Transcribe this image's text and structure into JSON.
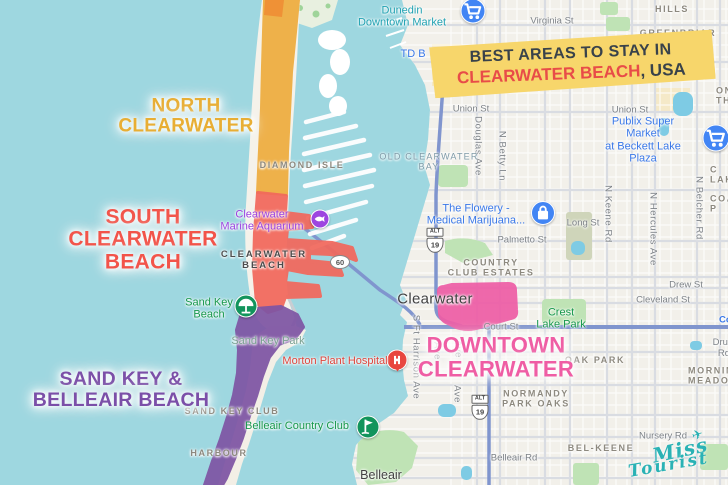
{
  "banner": {
    "line1": "BEST AREAS TO STAY IN",
    "line2_highlight": "CLEARWATER BEACH",
    "line2_suffix": ", USA",
    "bg_color": "#f7d66b",
    "highlight_color": "#e84c48",
    "text_color": "#39424a"
  },
  "logo": {
    "text1": "Miss",
    "text2": "Tourist",
    "plane": "✈",
    "color": "#2ab2b5"
  },
  "theme": {
    "water": "#9ed7e0",
    "land": "#f2f0ea",
    "park": "#bfe3b5",
    "pond": "#7ecbe4",
    "highway": "#8095ce"
  },
  "regions": [
    {
      "id": "north-clearwater",
      "label": "NORTH\nCLEARWATER",
      "color": "#eead3e",
      "cap_color": "#ee8f35",
      "label_color": "#e8ae34",
      "overlay_id": "ov-north",
      "cap_id": "ov-north-cap",
      "label_x": 186,
      "label_y": 117,
      "font_px": 19
    },
    {
      "id": "south-clearwater-beach",
      "label": "SOUTH\nCLEARWATER\nBEACH",
      "color": "#f2685c",
      "label_color": "#f2544a",
      "overlay_id": "ov-south",
      "label_x": 143,
      "label_y": 240,
      "font_px": 21
    },
    {
      "id": "sand-key-belleair-beach",
      "label": "SAND KEY &\nBELLEAIR BEACH",
      "color": "#7e55a4",
      "label_color": "#7b4fa8",
      "overlay_id": "ov-sandkey",
      "label_x": 121,
      "label_y": 390,
      "font_px": 19.5
    },
    {
      "id": "downtown-clearwater",
      "label": "DOWNTOWN\nCLEARWATER",
      "color": "#ee5ea6",
      "label_color": "#ef5da4",
      "overlay_id": "ov-downtown",
      "label_x": 496,
      "label_y": 357,
      "font_px": 22
    }
  ],
  "map": {
    "labels": [
      {
        "n": "street-virginia-st",
        "t": "Virginia St",
        "c": "st",
        "x": 552,
        "y": 22,
        "k": false
      },
      {
        "n": "street-union-st-west",
        "t": "Union St",
        "c": "st",
        "x": 471,
        "y": 110,
        "k": false
      },
      {
        "n": "street-union-st-east",
        "t": "Union St",
        "c": "st",
        "x": 630,
        "y": 111,
        "k": false
      },
      {
        "n": "street-long-st",
        "t": "Long St",
        "c": "st",
        "x": 583,
        "y": 224,
        "k": false
      },
      {
        "n": "street-palmetto-st",
        "t": "Palmetto St",
        "c": "st",
        "x": 522,
        "y": 241,
        "k": false
      },
      {
        "n": "street-court-st",
        "t": "Court St",
        "c": "st",
        "x": 501,
        "y": 328,
        "k": false
      },
      {
        "n": "street-drew-st",
        "t": "Drew St",
        "c": "st",
        "x": 686,
        "y": 286,
        "k": false
      },
      {
        "n": "street-cleveland-st",
        "t": "Cleveland St",
        "c": "st",
        "x": 663,
        "y": 301,
        "k": false
      },
      {
        "n": "street-druid-rd",
        "t": "Druid Rd",
        "c": "st",
        "x": 724,
        "y": 349,
        "k": false
      },
      {
        "n": "street-belleair-rd",
        "t": "Belleair Rd",
        "c": "st",
        "x": 514,
        "y": 459,
        "k": false
      },
      {
        "n": "street-nursery-rd",
        "t": "Nursery Rd",
        "c": "st",
        "x": 663,
        "y": 437,
        "k": false
      },
      {
        "n": "street-court-hwy-label",
        "t": "Cou",
        "c": "stb",
        "x": 719,
        "y": 321,
        "k": false,
        "la": true
      },
      {
        "n": "street-douglas-ave",
        "t": "Douglas Ave",
        "c": "stv",
        "x": 477,
        "y": 146,
        "k": false
      },
      {
        "n": "street-n-betty-ln",
        "t": "N Betty Ln",
        "c": "stv",
        "x": 501,
        "y": 156,
        "k": false
      },
      {
        "n": "street-n-keene-rd",
        "t": "N Keene Rd",
        "c": "stv",
        "x": 607,
        "y": 214,
        "k": false
      },
      {
        "n": "street-n-hercules-ave",
        "t": "N Hercules Ave",
        "c": "stv",
        "x": 652,
        "y": 229,
        "k": false
      },
      {
        "n": "street-n-belcher-rd",
        "t": "N Belcher Rd",
        "c": "stv",
        "x": 698,
        "y": 208,
        "k": false
      },
      {
        "n": "street-s-ft-harrison-ave",
        "t": "S Ft Harrison Ave",
        "c": "stv",
        "x": 415,
        "y": 357,
        "k": false
      },
      {
        "n": "street-ave-fragment-1",
        "t": "Ave",
        "c": "stv",
        "x": 436,
        "y": 351,
        "k": false
      },
      {
        "n": "street-ave-fragment-2",
        "t": "Ave",
        "c": "stv",
        "x": 457,
        "y": 349,
        "k": false
      },
      {
        "n": "street-ave-fragment-3",
        "t": "Ave",
        "c": "stv",
        "x": 456,
        "y": 394,
        "k": false
      },
      {
        "n": "hood-hills",
        "t": "HILLS",
        "c": "hd",
        "x": 672,
        "y": 9,
        "k": false
      },
      {
        "n": "hood-greenbriar",
        "t": "GREENBRIAR",
        "c": "hd",
        "x": 678,
        "y": 33,
        "k": false
      },
      {
        "n": "hood-diamond-isle",
        "t": "DIAMOND ISLE",
        "c": "hd",
        "x": 302,
        "y": 165,
        "k": false
      },
      {
        "n": "hood-country-club-estates",
        "t": "COUNTRY\nCLUB ESTATES",
        "c": "hd",
        "x": 491,
        "y": 268,
        "k": false
      },
      {
        "n": "hood-oak-park",
        "t": "OAK PARK",
        "c": "hd",
        "x": 595,
        "y": 360,
        "k": false
      },
      {
        "n": "hood-morningside-meadows",
        "t": "MORNINGSIDE\nMEADOWS",
        "c": "hd",
        "x": 688,
        "y": 376,
        "k": false,
        "la": true
      },
      {
        "n": "hood-normandy-park-oaks",
        "t": "NORMANDY\nPARK OAKS",
        "c": "hd",
        "x": 536,
        "y": 399,
        "k": false
      },
      {
        "n": "hood-bel-keene",
        "t": "BEL-KEENE",
        "c": "hd",
        "x": 601,
        "y": 448,
        "k": false
      },
      {
        "n": "hood-sand-key-club",
        "t": "SAND KEY CLUB",
        "c": "hd",
        "x": 232,
        "y": 411,
        "k": false
      },
      {
        "n": "hood-harbour",
        "t": "HARBOUR",
        "c": "hd",
        "x": 219,
        "y": 453,
        "k": false
      },
      {
        "n": "hood-edge-fragment-on",
        "t": "ON\nTH",
        "c": "hd",
        "x": 716,
        "y": 96,
        "k": false,
        "la": true
      },
      {
        "n": "hood-edge-fragment-lak",
        "t": "C\nLAK",
        "c": "hd",
        "x": 710,
        "y": 175,
        "k": false,
        "la": true
      },
      {
        "n": "hood-edge-fragment-coa",
        "t": "COA\nP",
        "c": "hd",
        "x": 710,
        "y": 204,
        "k": false,
        "la": true
      },
      {
        "n": "hood-clearwater-beach",
        "t": "CLEARWATER\nBEACH",
        "c": "hdd",
        "x": 264,
        "y": 261,
        "k": false
      },
      {
        "n": "water-old-clearwater-bay",
        "t": "OLD CLEARWATER\nBAY",
        "c": "wt",
        "x": 429,
        "y": 162,
        "k": false
      },
      {
        "n": "city-clearwater",
        "t": "Clearwater",
        "c": "city",
        "x": 435,
        "y": 299,
        "k": false
      },
      {
        "n": "city-belleair",
        "t": "Belleair",
        "c": "city2",
        "x": 381,
        "y": 475,
        "k": false
      },
      {
        "n": "poi-dunedin-downtown-market",
        "t": "Dunedin\nDowntown Market",
        "c": "poit",
        "x": 402,
        "y": 17,
        "k": true
      },
      {
        "n": "poi-td-bank",
        "t": "TD B",
        "c": "poi",
        "x": 413,
        "y": 54,
        "k": true
      },
      {
        "n": "poi-publix-super-market",
        "t": "Publix Super Market\nat Beckett Lake Plaza",
        "c": "poi",
        "x": 643,
        "y": 140,
        "k": true
      },
      {
        "n": "poi-the-flowery",
        "t": "The Flowery -\nMedical Marijuana...",
        "c": "poi",
        "x": 476,
        "y": 215,
        "k": true
      },
      {
        "n": "poi-clearwater-marine-aquarium",
        "t": "Clearwater\nMarine Aquarium",
        "c": "poip",
        "x": 262,
        "y": 221,
        "k": true
      },
      {
        "n": "poi-morton-plant-hospital",
        "t": "Morton Plant Hospital",
        "c": "poir",
        "x": 335,
        "y": 361,
        "k": true
      },
      {
        "n": "poi-sand-key-beach",
        "t": "Sand Key\nBeach",
        "c": "poig",
        "x": 209,
        "y": 309,
        "k": true
      },
      {
        "n": "poi-sand-key-park",
        "t": "Sand Key Park",
        "c": "poik",
        "x": 268,
        "y": 341,
        "k": false
      },
      {
        "n": "poi-belleair-country-club",
        "t": "Belleair Country Club",
        "c": "poig",
        "x": 297,
        "y": 426,
        "k": true
      },
      {
        "n": "poi-crest-lake-park",
        "t": "Crest\nLake Park",
        "c": "poig",
        "x": 561,
        "y": 319,
        "k": true
      }
    ],
    "icons": [
      {
        "name": "shopping-cart-icon",
        "glyph": "cart",
        "x": 473,
        "y": 11,
        "d": 23,
        "c": "#4285f4"
      },
      {
        "name": "shopping-cart-icon",
        "glyph": "cart",
        "x": 716,
        "y": 138,
        "d": 25,
        "c": "#4285f4"
      },
      {
        "name": "shopping-bag-icon",
        "glyph": "bag",
        "x": 543,
        "y": 213,
        "d": 22,
        "c": "#4285f4"
      },
      {
        "name": "aquarium-fish-icon",
        "glyph": "fish",
        "x": 320,
        "y": 219,
        "d": 17,
        "c": "#9d45e0"
      },
      {
        "name": "hospital-icon",
        "glyph": "hospital",
        "x": 397,
        "y": 360,
        "d": 19,
        "c": "#e8453e",
        "pin": true
      },
      {
        "name": "beach-umbrella-icon",
        "glyph": "beach",
        "x": 246,
        "y": 306,
        "d": 21,
        "c": "#12945c"
      },
      {
        "name": "golf-flag-icon",
        "glyph": "golf",
        "x": 368,
        "y": 427,
        "d": 21,
        "c": "#12945c"
      }
    ],
    "shields": [
      {
        "kind": "us",
        "alt": "ALT",
        "num": "19",
        "x": 435,
        "y": 240
      },
      {
        "kind": "us",
        "alt": "ALT",
        "num": "19",
        "x": 480,
        "y": 407
      },
      {
        "kind": "oval",
        "num": "60",
        "x": 340,
        "y": 262
      }
    ]
  }
}
